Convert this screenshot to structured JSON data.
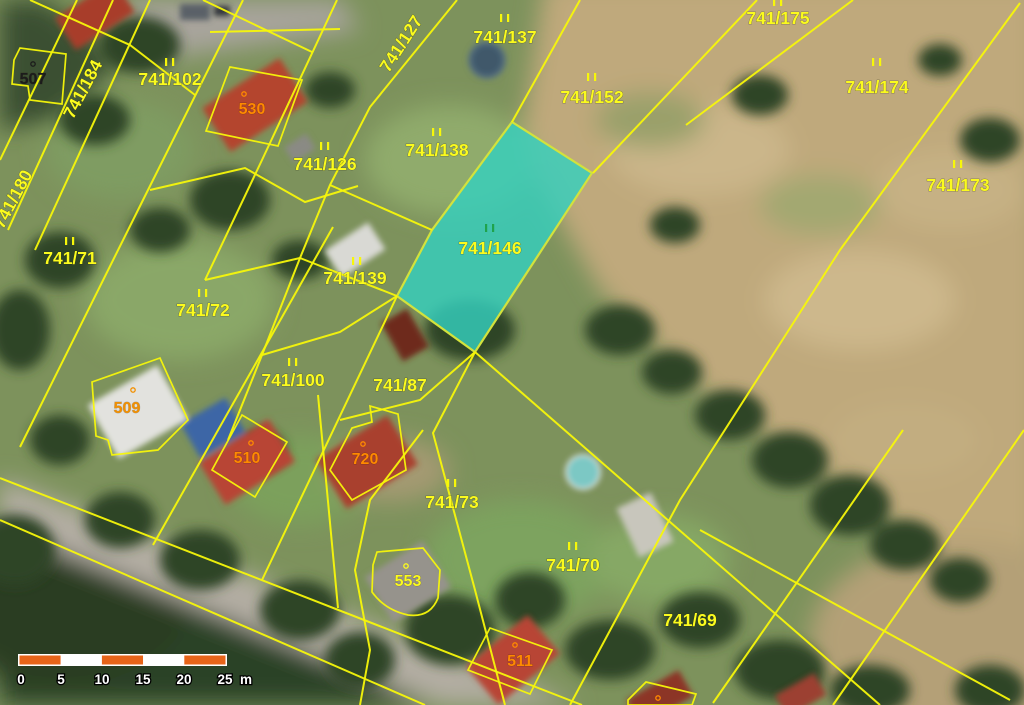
{
  "parcels": [
    {
      "id": "741/184"
    },
    {
      "id": "741/180"
    },
    {
      "id": "741/127"
    },
    {
      "id": "741/102"
    },
    {
      "id": "741/71"
    },
    {
      "id": "741/72"
    },
    {
      "id": "741/126"
    },
    {
      "id": "741/137"
    },
    {
      "id": "741/138"
    },
    {
      "id": "741/139"
    },
    {
      "id": "741/152"
    },
    {
      "id": "741/175"
    },
    {
      "id": "741/174"
    },
    {
      "id": "741/173"
    },
    {
      "id": "741/100"
    },
    {
      "id": "741/87"
    },
    {
      "id": "741/73"
    },
    {
      "id": "741/70"
    },
    {
      "id": "741/69"
    }
  ],
  "highlight": {
    "id": "741/146"
  },
  "buildings": [
    {
      "id": "507",
      "color": "#1c1c1c"
    },
    {
      "id": "530",
      "color": "#ff8a00"
    },
    {
      "id": "509",
      "color": "#f29000"
    },
    {
      "id": "510",
      "color": "#ff8a00"
    },
    {
      "id": "720",
      "color": "#ff8a00"
    },
    {
      "id": "553",
      "color": "#fbfb1e"
    },
    {
      "id": "511",
      "color": "#ff8a00"
    }
  ],
  "scalebar": {
    "ticks": [
      "0",
      "5",
      "10",
      "15",
      "20",
      "25"
    ],
    "unit": "m"
  },
  "colors": {
    "parcel_line": "#f7f70a",
    "parcel_label": "#fbfb1e",
    "building_label": "#ff8a00",
    "highlight_fill": "#35cfbe",
    "highlight_border": "#d2e23c",
    "highlight_label": "#1fa34c",
    "scalebar_orange": "#e76419"
  }
}
